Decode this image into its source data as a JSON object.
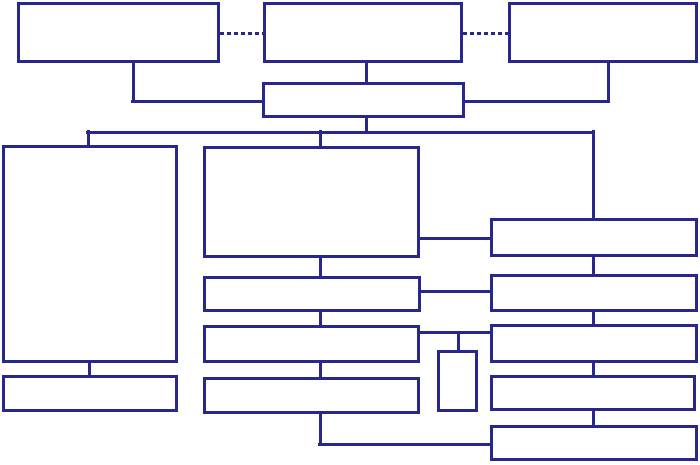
{
  "diagram": {
    "title": "",
    "background_color": "#ffffff",
    "line_color": "#28288c",
    "line_width": 3,
    "canvas": {
      "width": 700,
      "height": 465
    },
    "boxes": [
      {
        "id": "top-left",
        "x": 17,
        "y": 2,
        "w": 203,
        "h": 61
      },
      {
        "id": "top-center",
        "x": 263,
        "y": 2,
        "w": 200,
        "h": 61
      },
      {
        "id": "top-right",
        "x": 508,
        "y": 2,
        "w": 190,
        "h": 61
      },
      {
        "id": "center-hub",
        "x": 262,
        "y": 82,
        "w": 203,
        "h": 36
      },
      {
        "id": "left-tall",
        "x": 2,
        "y": 145,
        "w": 176,
        "h": 218
      },
      {
        "id": "left-bottom",
        "x": 2,
        "y": 375,
        "w": 176,
        "h": 37
      },
      {
        "id": "main-large",
        "x": 203,
        "y": 146,
        "w": 217,
        "h": 112
      },
      {
        "id": "mid-row-1",
        "x": 203,
        "y": 276,
        "w": 218,
        "h": 36
      },
      {
        "id": "mid-row-2",
        "x": 203,
        "y": 325,
        "w": 217,
        "h": 38
      },
      {
        "id": "mid-row-3",
        "x": 203,
        "y": 377,
        "w": 217,
        "h": 37
      },
      {
        "id": "small-vertical",
        "x": 437,
        "y": 350,
        "w": 41,
        "h": 62
      },
      {
        "id": "right-row-1",
        "x": 490,
        "y": 218,
        "w": 208,
        "h": 39
      },
      {
        "id": "right-row-2",
        "x": 490,
        "y": 274,
        "w": 208,
        "h": 38
      },
      {
        "id": "right-row-3",
        "x": 490,
        "y": 324,
        "w": 208,
        "h": 39
      },
      {
        "id": "right-row-4",
        "x": 490,
        "y": 375,
        "w": 206,
        "h": 36
      },
      {
        "id": "right-row-5",
        "x": 490,
        "y": 425,
        "w": 208,
        "h": 36
      }
    ],
    "connectors": [
      {
        "id": "dashed-top-left-to-center",
        "type": "h",
        "x": 220,
        "y": 33,
        "len": 43,
        "dashed": true
      },
      {
        "id": "dashed-top-center-to-right",
        "type": "h",
        "x": 463,
        "y": 33,
        "len": 45,
        "dashed": true
      },
      {
        "id": "top-left-drop",
        "type": "v",
        "x": 133,
        "y": 63,
        "len": 40,
        "dashed": false
      },
      {
        "id": "top-left-elbow",
        "type": "h",
        "x": 131,
        "y": 101,
        "len": 133,
        "dashed": false
      },
      {
        "id": "top-center-drop",
        "type": "v",
        "x": 366,
        "y": 63,
        "len": 20,
        "dashed": false
      },
      {
        "id": "top-right-drop",
        "type": "v",
        "x": 608,
        "y": 63,
        "len": 40,
        "dashed": false
      },
      {
        "id": "top-right-elbow",
        "type": "h",
        "x": 464,
        "y": 101,
        "len": 146,
        "dashed": false
      },
      {
        "id": "hub-drop",
        "type": "v",
        "x": 366,
        "y": 117,
        "len": 16,
        "dashed": false
      },
      {
        "id": "distribution-bus",
        "type": "h",
        "x": 86,
        "y": 132,
        "len": 509,
        "dashed": false
      },
      {
        "id": "bus-to-left-tall",
        "type": "v",
        "x": 88,
        "y": 130,
        "len": 17,
        "dashed": false
      },
      {
        "id": "bus-to-main-large",
        "type": "v",
        "x": 320,
        "y": 130,
        "len": 18,
        "dashed": false
      },
      {
        "id": "bus-to-right-row-1",
        "type": "v",
        "x": 593,
        "y": 130,
        "len": 90,
        "dashed": false
      },
      {
        "id": "left-tall-to-left-bottom",
        "type": "v",
        "x": 89,
        "y": 362,
        "len": 14,
        "dashed": false
      },
      {
        "id": "main-to-mid-row-1",
        "type": "v",
        "x": 320,
        "y": 257,
        "len": 20,
        "dashed": false
      },
      {
        "id": "mid-row-1-to-2",
        "type": "v",
        "x": 320,
        "y": 311,
        "len": 15,
        "dashed": false
      },
      {
        "id": "mid-row-2-to-3",
        "type": "v",
        "x": 320,
        "y": 362,
        "len": 16,
        "dashed": false
      },
      {
        "id": "mid-row-3-down",
        "type": "v",
        "x": 320,
        "y": 413,
        "len": 33,
        "dashed": false
      },
      {
        "id": "mid-bottom-elbow",
        "type": "h",
        "x": 318,
        "y": 444,
        "len": 174,
        "dashed": false
      },
      {
        "id": "main-to-right-row-1",
        "type": "h",
        "x": 419,
        "y": 238,
        "len": 72,
        "dashed": false
      },
      {
        "id": "mid-row-1-to-right-row-2",
        "type": "h",
        "x": 420,
        "y": 291,
        "len": 71,
        "dashed": false
      },
      {
        "id": "mid-row-2-to-right-row-3",
        "type": "h",
        "x": 419,
        "y": 332,
        "len": 72,
        "dashed": false
      },
      {
        "id": "drop-to-small-vertical",
        "type": "v",
        "x": 458,
        "y": 331,
        "len": 20,
        "dashed": false
      },
      {
        "id": "right-row-1-to-2",
        "type": "v",
        "x": 593,
        "y": 256,
        "len": 19,
        "dashed": false
      },
      {
        "id": "right-row-2-to-3",
        "type": "v",
        "x": 593,
        "y": 311,
        "len": 14,
        "dashed": false
      },
      {
        "id": "right-row-3-to-4",
        "type": "v",
        "x": 593,
        "y": 362,
        "len": 14,
        "dashed": false
      },
      {
        "id": "right-row-4-to-5",
        "type": "v",
        "x": 593,
        "y": 410,
        "len": 16,
        "dashed": false
      }
    ]
  }
}
